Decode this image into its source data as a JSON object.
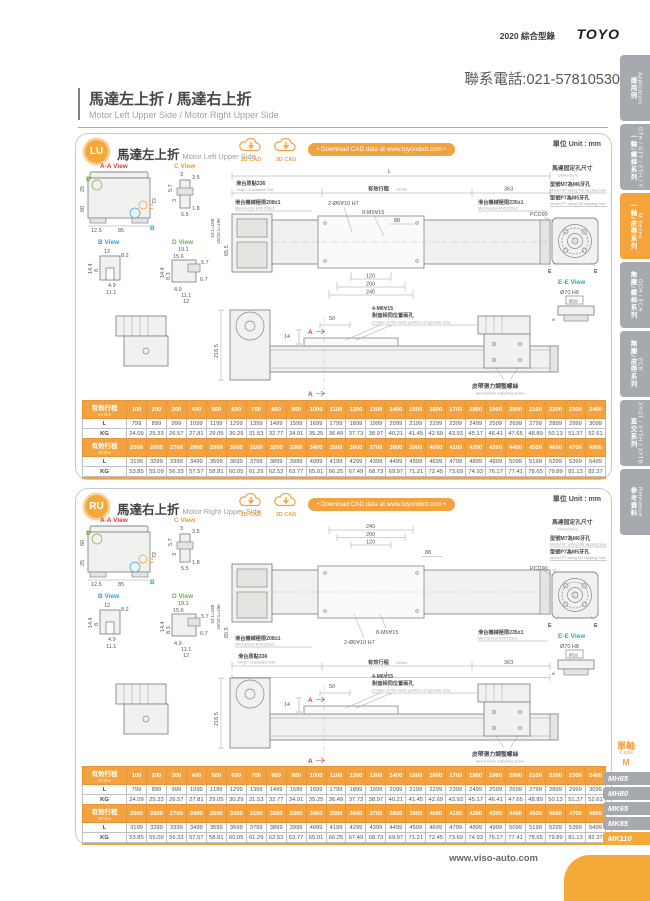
{
  "header": {
    "catalog": "2020 綜合型錄",
    "logo": "TOYO",
    "phone": "聯系電話:021-57810530"
  },
  "page_title": {
    "zh": "馬達左上折 / 馬達右上折",
    "en": "Motor Left Upper Side / Motor Right Upper Side"
  },
  "sidebar": {
    "tabs": [
      {
        "zh": "應用例",
        "en": "Application",
        "active": false
      },
      {
        "zh": "一軸/螺桿系列",
        "en": "GTH / GTY / ETH / Y",
        "active": false
      },
      {
        "zh": "一軸/皮帶系列",
        "en": "M Series",
        "active": true
      },
      {
        "zh": "無塵/螺桿系列",
        "en": "GCH / ECH",
        "active": false
      },
      {
        "zh": "無塵/皮帶系列",
        "en": "ECB",
        "active": false
      },
      {
        "zh": "直交系列",
        "en": "XYOT / XYTH / XYTB",
        "active": false
      },
      {
        "zh": "參考資料",
        "en": "Reference",
        "active": false
      }
    ]
  },
  "common": {
    "unit": "單位 Unit : mm",
    "cad2d": "2D CAD",
    "cad3d": "3D CAD",
    "download": "• Download CAD data at www.toyorobot.com •"
  },
  "lu": {
    "badge": "LU",
    "title_zh": "馬達左上折",
    "title_en": "Motor Left Upper Side"
  },
  "ru": {
    "badge": "RU",
    "title_zh": "馬達右上折",
    "title_en": "Motor Right Upper Side"
  },
  "drawing": {
    "views": {
      "aa": "A-A View",
      "b": "B View",
      "c": "C View",
      "d": "D View",
      "ee": "E-E View"
    },
    "aa": {
      "w25": "25",
      "w60": "60",
      "h72": "72",
      "b125": "12.5",
      "b85": "85",
      "cD": "D",
      "cC": "C",
      "cB": "B"
    },
    "c": {
      "d1": "3",
      "d2": "3.5",
      "d3": "5.7",
      "d4": "3",
      "d5": "1.8",
      "d6": "5.5"
    },
    "b": {
      "d1": "12",
      "d2": "8.2",
      "d3": "14.4",
      "d4": "8",
      "d5": "4.9",
      "d6": "11.1"
    },
    "d": {
      "d1": "19.1",
      "d2": "15.6",
      "d3": "5.7",
      "d4": "14.4",
      "d5": "8.3",
      "d6": "4.9",
      "d7": "6.7",
      "d8": "11.1",
      "d9": "12"
    },
    "ratio1": "10:1=188",
    "ratio2": "15/20:1=196",
    "h655": "65.5",
    "main": {
      "L": "L",
      "origin_zh": "滑台原點336",
      "origin_en": "Origin of actuator:336",
      "stroke_zh": "有效行程",
      "stroke_en": "Stroke",
      "end": "363",
      "mech1_zh": "滑台機械極限208±1",
      "mech1_en": "Mechanical limit:208±1",
      "mech2_zh": "滑台機械極限235±1",
      "mech2_en": "Mechanical limit:235±1",
      "holes1": "2-Ø6∀10 H7",
      "holes2": "8-M6∀15",
      "d88": "88",
      "d110": "110",
      "d120": "120",
      "d200": "200",
      "d240": "240"
    },
    "mount": {
      "title_zh": "馬達固定孔尺寸",
      "title_en": "Dimensions",
      "m7_zh": "型號M7為M6牙孔",
      "m7_en": "Model M7 using M6 tapping hole",
      "p7_zh": "型號P7為M5牙孔",
      "p7_en": "Model P7 using M5 tapping hole",
      "pcd": "PCD90",
      "d70": "Ø70 H8",
      "d19": "Ø19",
      "d9": "9",
      "e": "E"
    },
    "side": {
      "h2165": "216.5",
      "d14": "14",
      "d50": "50",
      "holes_zh1": "4-M6∀15",
      "holes_zh2": "對面相同位置兩孔",
      "holes_en": "2 holes on the same position at opposite side.",
      "a": "A",
      "belt_zh": "皮帶張力調整螺絲",
      "belt_en": "Belt tension adjusting screw."
    }
  },
  "stroke_tables": [
    {
      "label_zh": "有效行程",
      "label_en": "Stroke",
      "strokes": [
        "100",
        "200",
        "300",
        "400",
        "500",
        "600",
        "700",
        "800",
        "900",
        "1000",
        "1100",
        "1200",
        "1300",
        "1400",
        "1500",
        "1600",
        "1700",
        "1800",
        "1900",
        "2000",
        "2100",
        "2200",
        "2300",
        "2400"
      ],
      "rows": [
        {
          "label": "L",
          "values": [
            "799",
            "899",
            "999",
            "1099",
            "1199",
            "1299",
            "1399",
            "1499",
            "1599",
            "1699",
            "1799",
            "1899",
            "1999",
            "2099",
            "2199",
            "2299",
            "2399",
            "2499",
            "2599",
            "2699",
            "2799",
            "2899",
            "2999",
            "3099"
          ]
        },
        {
          "label": "KG",
          "values": [
            "24.09",
            "25.33",
            "26.57",
            "27.81",
            "29.05",
            "30.29",
            "31.53",
            "32.77",
            "34.01",
            "35.25",
            "36.49",
            "37.73",
            "38.97",
            "40.21",
            "41.45",
            "42.69",
            "43.93",
            "45.17",
            "46.41",
            "47.65",
            "48.89",
            "50.13",
            "51.37",
            "52.61"
          ]
        }
      ]
    },
    {
      "label_zh": "有效行程",
      "label_en": "Stroke",
      "strokes": [
        "2500",
        "2600",
        "2700",
        "2800",
        "2900",
        "3000",
        "3100",
        "3200",
        "3300",
        "3400",
        "3500",
        "3600",
        "3700",
        "3800",
        "3900",
        "4000",
        "4100",
        "4200",
        "4300",
        "4400",
        "4500",
        "4600",
        "4700",
        "4800"
      ],
      "rows": [
        {
          "label": "L",
          "values": [
            "3199",
            "3299",
            "3399",
            "3499",
            "3599",
            "3699",
            "3799",
            "3899",
            "3999",
            "4099",
            "4199",
            "4299",
            "4399",
            "4499",
            "4599",
            "4699",
            "4799",
            "4899",
            "4999",
            "5099",
            "5199",
            "5299",
            "5399",
            "5499"
          ]
        },
        {
          "label": "KG",
          "values": [
            "53.85",
            "55.09",
            "56.33",
            "57.57",
            "58.81",
            "60.05",
            "61.29",
            "62.53",
            "63.77",
            "65.01",
            "66.25",
            "67.49",
            "68.73",
            "69.97",
            "71.21",
            "72.45",
            "73.69",
            "74.93",
            "76.17",
            "77.41",
            "78.65",
            "79.89",
            "81.13",
            "82.37"
          ]
        }
      ]
    }
  ],
  "model_nav": {
    "group_zh": "單軸",
    "group_en": "1 axis",
    "series": "M",
    "items": [
      {
        "label": "MH65",
        "active": false
      },
      {
        "label": "MH80",
        "active": false
      },
      {
        "label": "MK65",
        "active": false
      },
      {
        "label": "MK85",
        "active": false
      },
      {
        "label": "MK110",
        "active": true
      }
    ]
  },
  "footer": {
    "url": "www.viso-auto.com"
  }
}
